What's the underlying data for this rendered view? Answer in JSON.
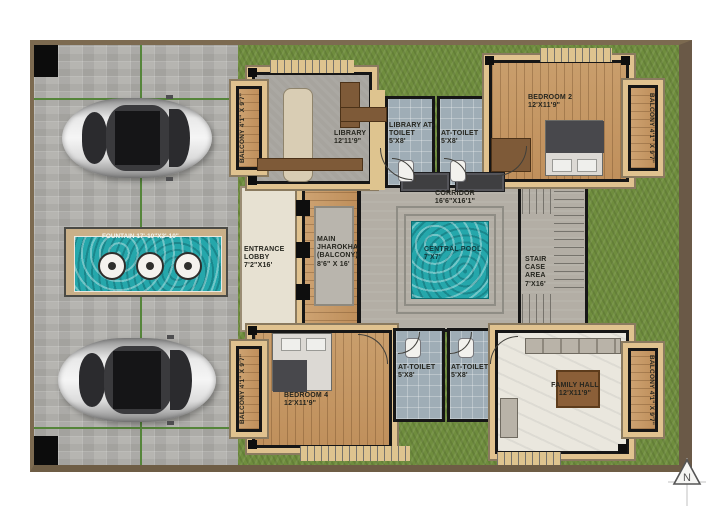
{
  "compass": {
    "label": "N"
  },
  "rooms": {
    "balcony_tl": {
      "name": "BALCONY",
      "dims": "4'1\" X 9'7\""
    },
    "library": {
      "name": "LIBRARY",
      "dims": "12'11'9\""
    },
    "library_toilet": {
      "name": "LIBRARY AT-TOILET",
      "dims": "5'X8'"
    },
    "toilet_top": {
      "name": "AT-TOILET",
      "dims": "5'X8'"
    },
    "bedroom2": {
      "name": "BEDROOM 2",
      "dims": "12'X11'9\""
    },
    "balcony_tr": {
      "name": "BALCONY",
      "dims": "4'1\" X 9'7\""
    },
    "corridor": {
      "name": "CORRIDOR",
      "dims": "16'6\"X16'1\""
    },
    "pool": {
      "name": "CENTRAL POOL",
      "dims": "7'X7'"
    },
    "entrance": {
      "name": "ENTRANCE LOBBY",
      "dims": "7'2\"X16'"
    },
    "jharokha": {
      "name": "MAIN JHAROKHA (BALCONY)",
      "dims": "8'6\" X 16'"
    },
    "stair": {
      "name": "STAIR CASE AREA",
      "dims": "7'X16'"
    },
    "bedroom4": {
      "name": "BEDROOM 4",
      "dims": "12'X11'9\""
    },
    "balcony_bl": {
      "name": "BALCONY",
      "dims": "4'1\" X 9'7\""
    },
    "toilet_bl": {
      "name": "AT-TOILET",
      "dims": "5'X8'"
    },
    "toilet_br": {
      "name": "AT-TOILET",
      "dims": "5'X8'"
    },
    "family_hall": {
      "name": "FAMILY HALL",
      "dims": "12'X11'9\""
    },
    "balcony_br": {
      "name": "BALCONY",
      "dims": "4'1\" X 9'7\""
    },
    "fountain": {
      "name": "FOUNTAIN",
      "dims": "17'-10\"X3'-10\""
    }
  },
  "colors": {
    "grass": "#6f8d3e",
    "paver": "#b6b5b1",
    "water": "#25a7ab",
    "wood": "#c99e6c",
    "wall": "#161616",
    "plinth": "#e0c28f",
    "boundary": "#6e5d45"
  }
}
